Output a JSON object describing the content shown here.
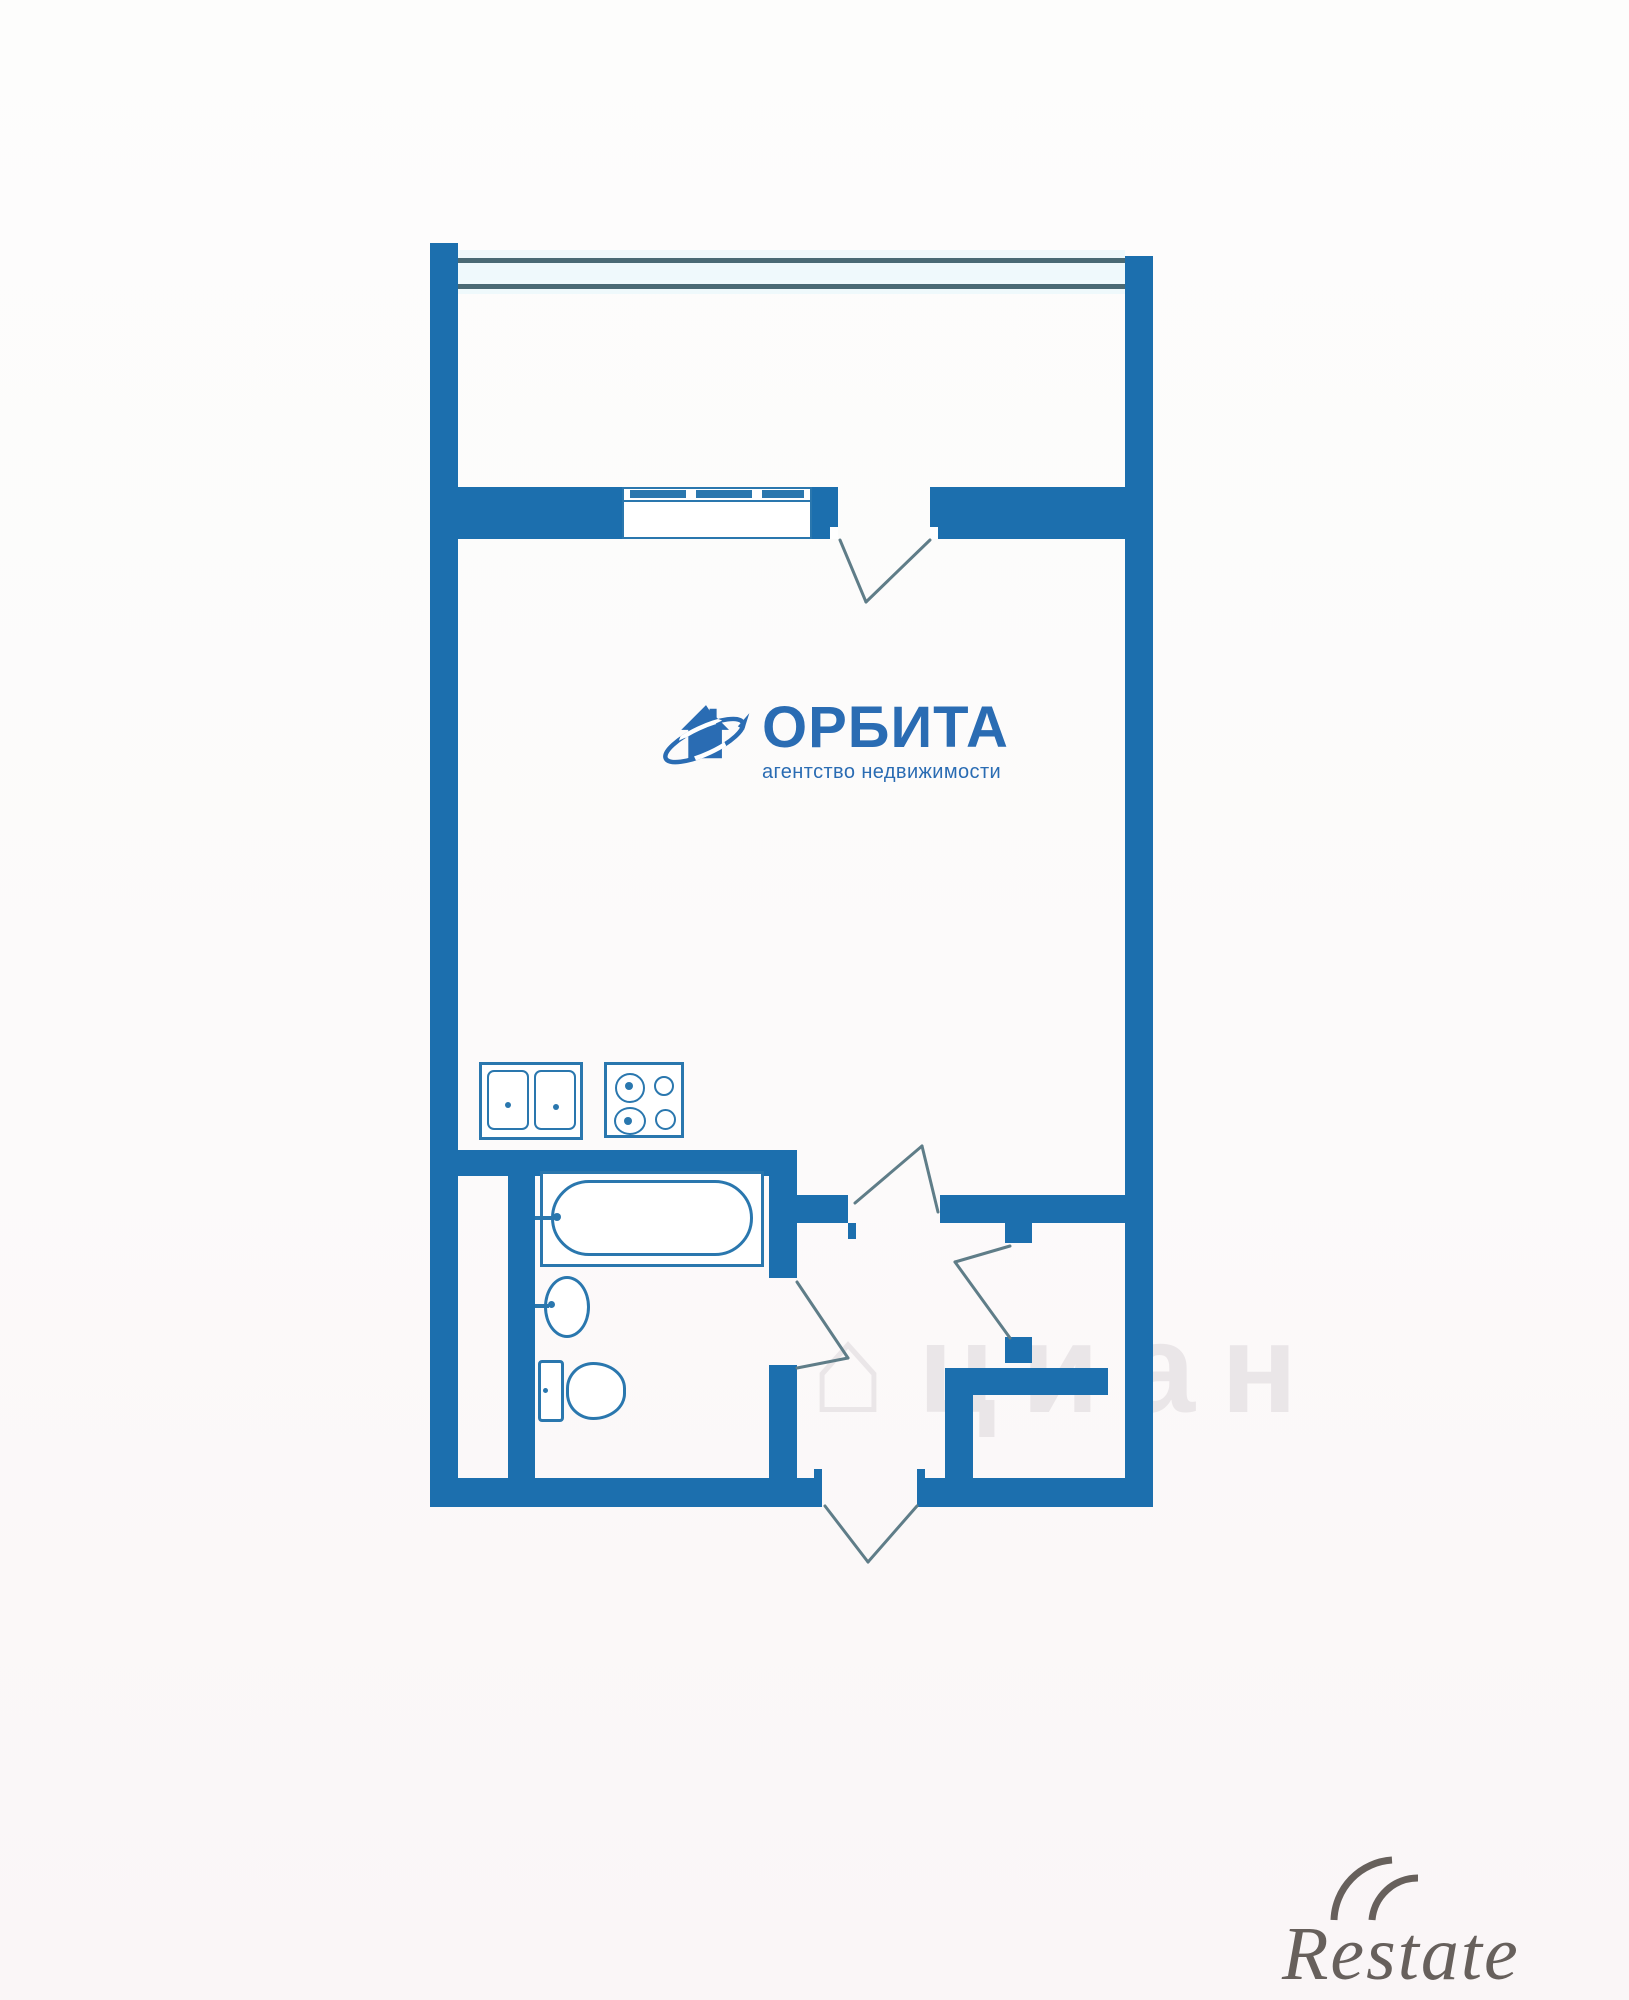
{
  "logo": {
    "brand": "ОРБИТА",
    "tagline": "агентство недвижимости",
    "icon": "house-orbit-icon"
  },
  "watermarks": {
    "cian_icon": "⌂",
    "cian_text": "циан",
    "restate_text": "Restate"
  },
  "colors": {
    "wall_blue": "#1c6fae",
    "fixture_blue": "#2a77ae",
    "window_line": "#4a6a75",
    "swing_gray": "#5f7d88",
    "logo_blue": "#2a6cb3",
    "cian_gray": "rgba(207,200,205,0.38)",
    "restate_gray": "#4e4742"
  },
  "floorplan": {
    "type": "studio-apartment-plan",
    "rooms": [
      {
        "name": "balcony"
      },
      {
        "name": "studio-room"
      },
      {
        "name": "kitchen-zone"
      },
      {
        "name": "bathroom"
      },
      {
        "name": "hallway"
      },
      {
        "name": "closet-niche"
      }
    ],
    "fixtures": [
      "double-kitchen-sink",
      "four-burner-stove",
      "bathtub",
      "wash-basin",
      "toilet"
    ],
    "openings": [
      "balcony-glazing-window",
      "balcony-window",
      "balcony-door",
      "room-door",
      "bathroom-door",
      "closet-door",
      "entry-door"
    ]
  }
}
